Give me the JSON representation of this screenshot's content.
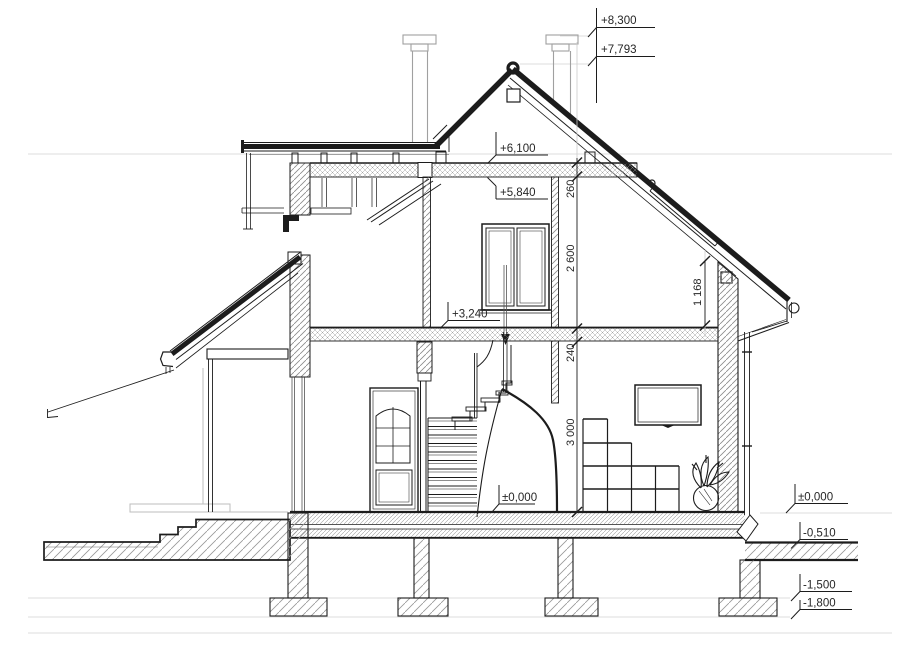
{
  "drawing": {
    "title": "House cross-section",
    "type": "architectural-section"
  },
  "levels": {
    "chimney_top": "+8,300",
    "ridge": "+7,793",
    "attic_ceiling_top": "+6,100",
    "attic_ceiling_bottom": "+5,840",
    "attic_floor": "+3,240",
    "ground_floor_interior": "±0,000",
    "ground_floor_right": "±0,000",
    "exterior_grade": "-0,510",
    "footing_top": "-1,500",
    "footing_bottom": "-1,800"
  },
  "dims": {
    "attic_slab_thickness": "260",
    "attic_storey_height": "2 600",
    "floor_slab_thickness": "240",
    "ground_storey_height": "3 000",
    "knee_wall_height": "1 168"
  },
  "colors": {
    "line": "#1c1c1c",
    "thin": "#3a3a3a",
    "faint": "#dcdcdc",
    "gray": "#a8a8a8",
    "hatch": "#8a8a8a"
  }
}
